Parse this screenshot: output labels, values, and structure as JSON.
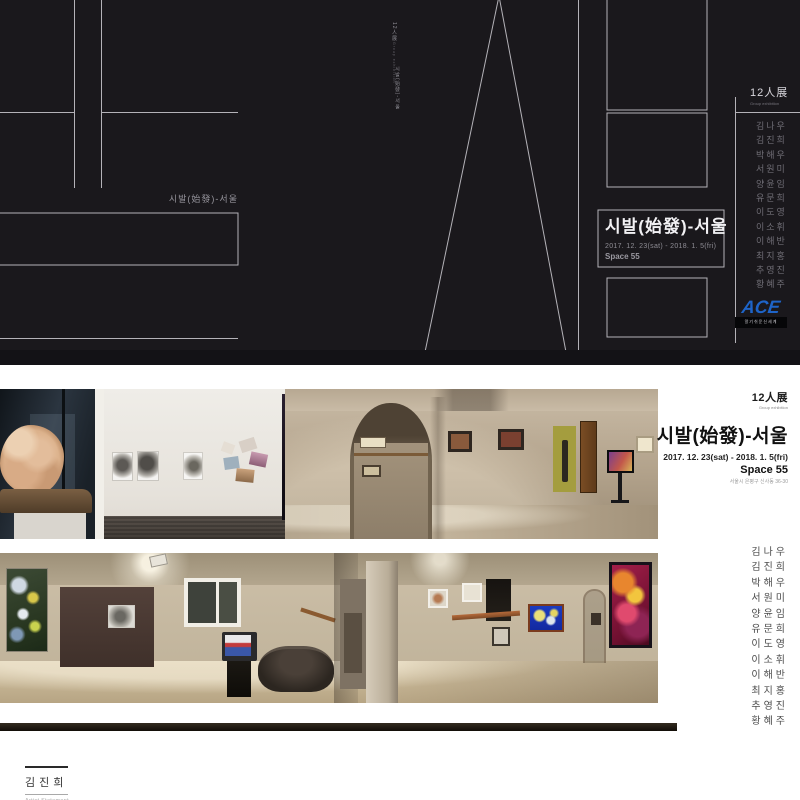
{
  "poster": {
    "background": "#1a181c",
    "vertical_caption": "12人展",
    "vertical_caption_sub": "Group exhibition",
    "vertical_caption_2": "시발(始發)-서울",
    "left_caption": "시발(始發)-서울",
    "title": "시발(始發)-서울",
    "date_range": "2017. 12. 23(sat) - 2018. 1. 5(fri)",
    "venue": "Space 55",
    "group_label": "12人展",
    "group_sublabel": "Group exhibition",
    "artists": [
      "김나우",
      "김진희",
      "박해우",
      "서원미",
      "양윤임",
      "유문희",
      "이도영",
      "이소휘",
      "이해반",
      "최지홍",
      "추영진",
      "황혜주"
    ],
    "sponsor_logo": "ACE",
    "sponsor_tagline": "알기쉬운신세계"
  },
  "info_panel": {
    "group_label": "12人展",
    "group_sublabel": "Group exhibition",
    "title": "시발(始發)-서울",
    "date_range": "2017. 12. 23(sat) - 2018. 1. 5(fri)",
    "venue": "Space 55",
    "address": "서울시 은평구 신사동 36-30",
    "artists": [
      "김나우",
      "김진희",
      "박해우",
      "서원미",
      "양윤임",
      "유문희",
      "이도영",
      "이소휘",
      "이해반",
      "최지홍",
      "추영진",
      "황혜주"
    ]
  },
  "footer": {
    "artist_name": "김진희",
    "label": "Artist Statement"
  },
  "colors": {
    "sponsor_blue": "#1e64c8",
    "poster_bg": "#1a181c"
  }
}
